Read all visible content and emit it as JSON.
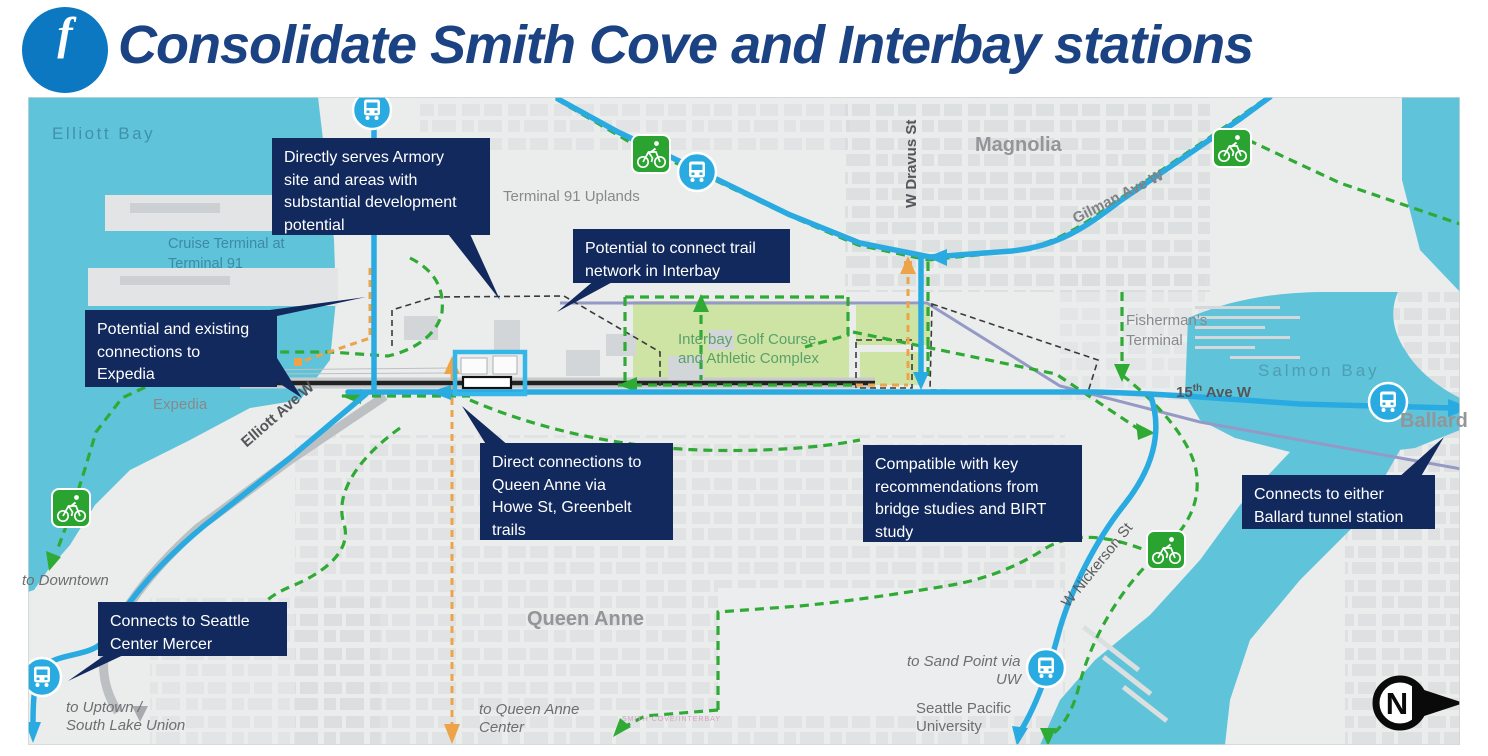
{
  "header": {
    "badge": "f",
    "title": "Consolidate Smith Cove and Interbay stations"
  },
  "map": {
    "colors": {
      "callout_bg": "#12295e",
      "water": "#5fc4da",
      "transit_blue": "#29abe2",
      "trail_green": "#2faa35",
      "orange": "#eda449",
      "golf_green": "#cde4a5",
      "title_blue": "#1b4282",
      "badge_blue": "#0d78c2"
    },
    "callouts": [
      {
        "id": "armory",
        "lines": [
          "Directly serves Armory",
          "site and areas with",
          "substantial development",
          "potential"
        ]
      },
      {
        "id": "trail-network",
        "lines": [
          "Potential to connect trail",
          "network in Interbay"
        ]
      },
      {
        "id": "expedia",
        "lines": [
          "Potential and existing",
          "connections to",
          "Expedia"
        ]
      },
      {
        "id": "queen-anne",
        "lines": [
          "Direct connections to",
          "Queen Anne via",
          "Howe St, Greenbelt",
          "trails"
        ]
      },
      {
        "id": "bridge-studies",
        "lines": [
          "Compatible with key",
          "recommendations from",
          "bridge studies and BIRT",
          "study"
        ]
      },
      {
        "id": "ballard-tunnel",
        "lines": [
          "Connects to either",
          "Ballard tunnel station"
        ]
      },
      {
        "id": "seattle-center",
        "lines": [
          "Connects to Seattle",
          "Center Mercer"
        ]
      }
    ],
    "labels": {
      "elliott_bay": "Elliott Bay",
      "cruise1": "Cruise Terminal at",
      "cruise2": "Terminal 91",
      "uplands": "Terminal 91 Uplands",
      "magnolia": "Magnolia",
      "dravus": "W Dravus St",
      "gilman": "Gilman Ave W",
      "fisherman1": "Fisherman's",
      "fisherman2": "Terminal",
      "salmon_bay": "Salmon Bay",
      "fifteenth_base": "15",
      "fifteenth_sup": "th",
      "fifteenth_rest": " Ave W",
      "ballard": "Ballard",
      "expedia": "Expedia",
      "elliott_ave": "Elliott Ave W",
      "queen_anne": "Queen Anne",
      "to_downtown": "to Downtown",
      "uptown1": "to Uptown /",
      "uptown2": "South Lake Union",
      "qac1": "to Queen Anne",
      "qac2": "Center",
      "sandpoint1": "to Sand Point via",
      "sandpoint2": "UW",
      "spu1": "Seattle Pacific",
      "spu2": "University",
      "nickerson": "W Nickerson St",
      "golf1": "Interbay Golf Course",
      "golf2": "and Athletic Complex",
      "smith_cove_tiny": "SMITH COVE/INTERBAY",
      "north": "N"
    }
  }
}
